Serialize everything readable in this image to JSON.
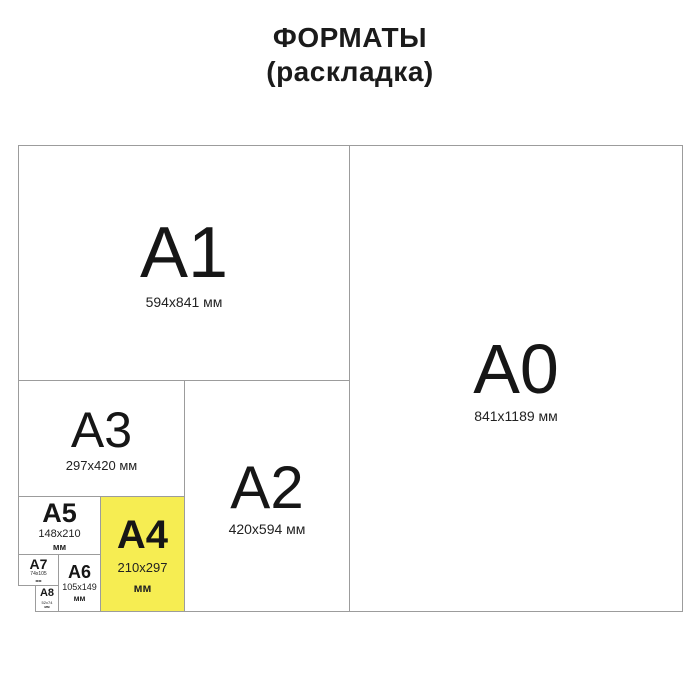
{
  "title": {
    "line1": "ФОРМАТЫ",
    "line2": "(раскладка)"
  },
  "colors": {
    "highlight": "#f6ed52",
    "line": "#9c9c9c",
    "text": "#1a1a1a"
  },
  "formats": {
    "a0": {
      "label": "A0",
      "size": "841x1189",
      "unit": "мм"
    },
    "a1": {
      "label": "A1",
      "size": "594x841",
      "unit": "мм"
    },
    "a2": {
      "label": "A2",
      "size": "420x594",
      "unit": "мм"
    },
    "a3": {
      "label": "A3",
      "size": "297x420",
      "unit": "мм"
    },
    "a4": {
      "label": "A4",
      "size": "210x297",
      "unit": "мм",
      "highlighted": true
    },
    "a5": {
      "label": "A5",
      "size": "148x210",
      "unit": "мм"
    },
    "a6": {
      "label": "A6",
      "size": "105x149",
      "unit": "мм"
    },
    "a7": {
      "label": "A7",
      "size": "74x105",
      "unit": "мм"
    },
    "a8": {
      "label": "A8",
      "size": "52x74",
      "unit": "мм"
    }
  }
}
